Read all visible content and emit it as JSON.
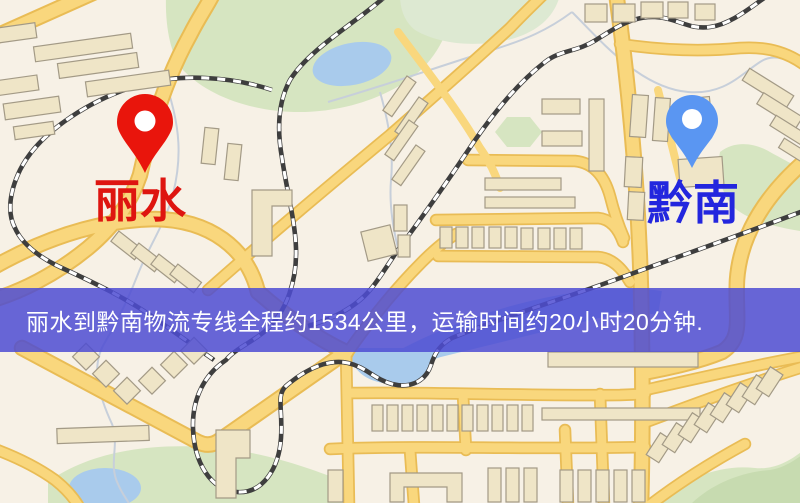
{
  "banner": {
    "text": "丽水到黔南物流专线全程约1534公里，运输时间约20小时20分钟.",
    "background_color": "rgba(78,76,210,0.85)",
    "text_color": "#ffffff"
  },
  "markers": {
    "origin": {
      "label": "丽水",
      "pin_color": "#E9150C",
      "pin_hole_color": "#FFFFFF",
      "label_color": "#DE1510"
    },
    "destination": {
      "label": "黔南",
      "pin_color": "#5A96F2",
      "pin_hole_color": "#FFFFFF",
      "label_color": "#2326DE"
    }
  },
  "map_colors": {
    "background": "#F7F1E6",
    "road_fill": "#F9D77D",
    "road_casing": "#E9BC55",
    "road_orange": "#EFA955",
    "building_fill": "#EFE5C7",
    "building_stroke": "#A39A86",
    "park": "#D6E5C1",
    "water": "#A9CBEC",
    "railway": "#3E3E3E"
  }
}
